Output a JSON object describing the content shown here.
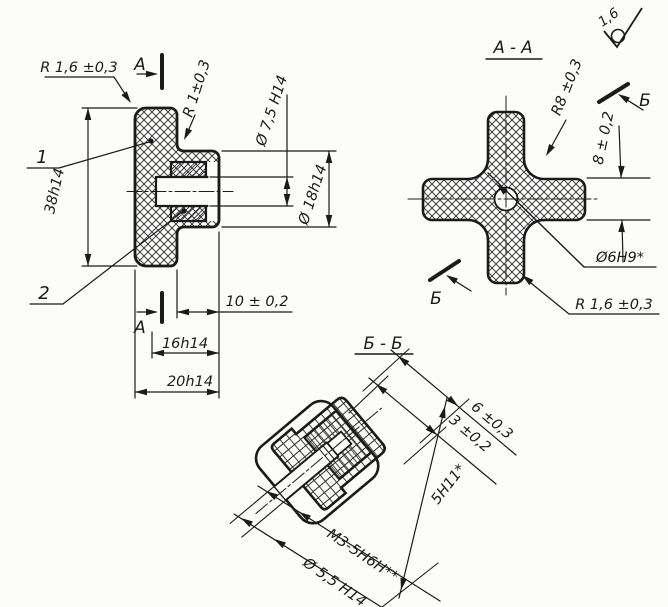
{
  "colors": {
    "ink": "#1a1a1a",
    "paper": "#fcfcfb"
  },
  "roughness": {
    "value": "1,6"
  },
  "main_view": {
    "cut_label": "А",
    "callout_flange": "1",
    "callout_insert": "2",
    "dim_corner_r": "R 1,6 ±0,3",
    "dim_fillet_r": "R 1±0,3",
    "dim_hole": "Ø 7,5 H14",
    "dim_hub": "Ø 18h14",
    "dim_height": "38h14",
    "dim_hub_len": "10 ± 0,2",
    "dim_len16": "16h14",
    "dim_len20": "20h14"
  },
  "section_aa": {
    "title": "А - А",
    "cut_label": "Б",
    "dim_fillet": "R8 ±0,3",
    "dim_arm": "8 ± 0,2",
    "dim_hole": "Ø6H9*",
    "dim_corner": "R 1,6 ±0,3"
  },
  "section_bb": {
    "title": "Б - Б",
    "dim_6": "6 ±0,3",
    "dim_3": "3 ±0,2",
    "dim_square": "5H11*",
    "dim_thread": "М3-5Н6Н**",
    "dim_hole": "Ø 5,5 H14"
  }
}
